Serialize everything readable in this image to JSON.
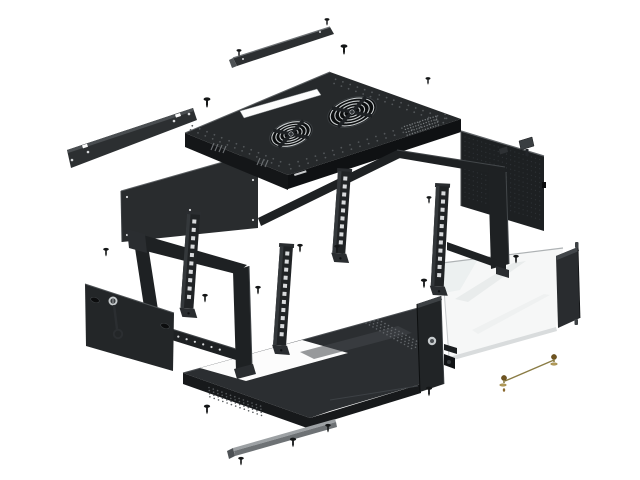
{
  "scene": {
    "description": "Exploded isometric diagram of a wall-mounted 19-inch network rack cabinet with glass door, fan roof, side panels, rack rails, base tray and mounting hardware",
    "background": "#ffffff"
  },
  "colors": {
    "bg": "#ffffff",
    "panel_top": "#26292b",
    "panel_face": "#141618",
    "panel_face2": "#0f1113",
    "panel_rear": "#292c2e",
    "panel_side": "#232628",
    "panel_right": "#1d2022",
    "frame": "#1e2123",
    "frame2": "#202325",
    "frame_light": "#2a2d30",
    "tray_top": "#2b2e31",
    "tray_face": "#17191b",
    "highlight": "#5a5e61",
    "hole_light": "#d8dadc",
    "dot": "#53575a",
    "strip_dark": "#2c2f31",
    "strip_gray": "#6e7275",
    "strip_gray_light": "#9da1a4",
    "glass": "#f6f7f7",
    "glass_streak": "#e9ecec",
    "glass_edge": "#c2c5c7",
    "pillar": "#292c2f",
    "brass": "#8a7c45",
    "brass_dark": "#6f5420",
    "brass_light": "#b29a58",
    "screw": "#141617",
    "silver": "#c7cbcd",
    "white": "#fcfcfc",
    "fan_bg": "#0c0e0f",
    "fan_arc": "#c6cacc",
    "fan_cross": "#1e2124"
  },
  "counts": {
    "screws": 18,
    "fans": 2,
    "rack_rails": 4
  },
  "screws": [
    [
      239,
      51,
      0.8
    ],
    [
      327,
      20,
      0.8
    ],
    [
      344,
      47,
      1.1
    ],
    [
      207,
      100,
      1.1
    ],
    [
      428,
      79,
      0.8
    ],
    [
      429,
      198,
      0.8
    ],
    [
      106,
      250,
      0.9
    ],
    [
      300,
      246,
      0.9
    ],
    [
      337,
      247,
      0.9
    ],
    [
      258,
      288,
      0.9
    ],
    [
      205,
      296,
      0.9
    ],
    [
      516,
      257,
      0.9
    ],
    [
      424,
      281,
      1.0
    ],
    [
      429,
      389,
      1.0
    ],
    [
      207,
      407,
      1.0
    ],
    [
      241,
      459,
      0.9
    ],
    [
      293,
      440,
      1.0
    ],
    [
      328,
      426,
      0.9
    ]
  ],
  "fans": [
    {
      "cx": 291,
      "cy": 134,
      "rx": 22,
      "ry": 12.5,
      "rot": -18
    },
    {
      "cx": 352,
      "cy": 112,
      "rx": 25,
      "ry": 14,
      "rot": -18
    }
  ],
  "rails": [
    {
      "x": 187,
      "y": 214,
      "h": 94,
      "rot": 4,
      "holes": 10
    },
    {
      "x": 280,
      "y": 246,
      "h": 99,
      "rot": 4,
      "holes": 11
    },
    {
      "x": 338,
      "y": 171,
      "h": 82,
      "rot": 4,
      "holes": 9
    },
    {
      "x": 436,
      "y": 186,
      "h": 100,
      "rot": 3,
      "holes": 11
    }
  ],
  "frame_bar_holes": {
    "x": 170,
    "y": 334,
    "dx": 8.3,
    "dy": 2.6,
    "n": 7
  },
  "ground_wire": {
    "x1": 505,
    "y1": 381,
    "x2": 554,
    "y2": 360
  },
  "parts": [
    "wall-mount-bracket",
    "top-cover-strip",
    "rear-panel",
    "roof-panel",
    "fan-grille",
    "cable-entry-slot",
    "base-tray",
    "wall-frame",
    "side-panel-with-lock",
    "key",
    "right-side-panel",
    "glass-door",
    "front-lock-post",
    "cabinet-body-frame",
    "rack-mounting-rail",
    "bottom-cover-strip",
    "mounting-screw",
    "grounding-wire-kit"
  ]
}
